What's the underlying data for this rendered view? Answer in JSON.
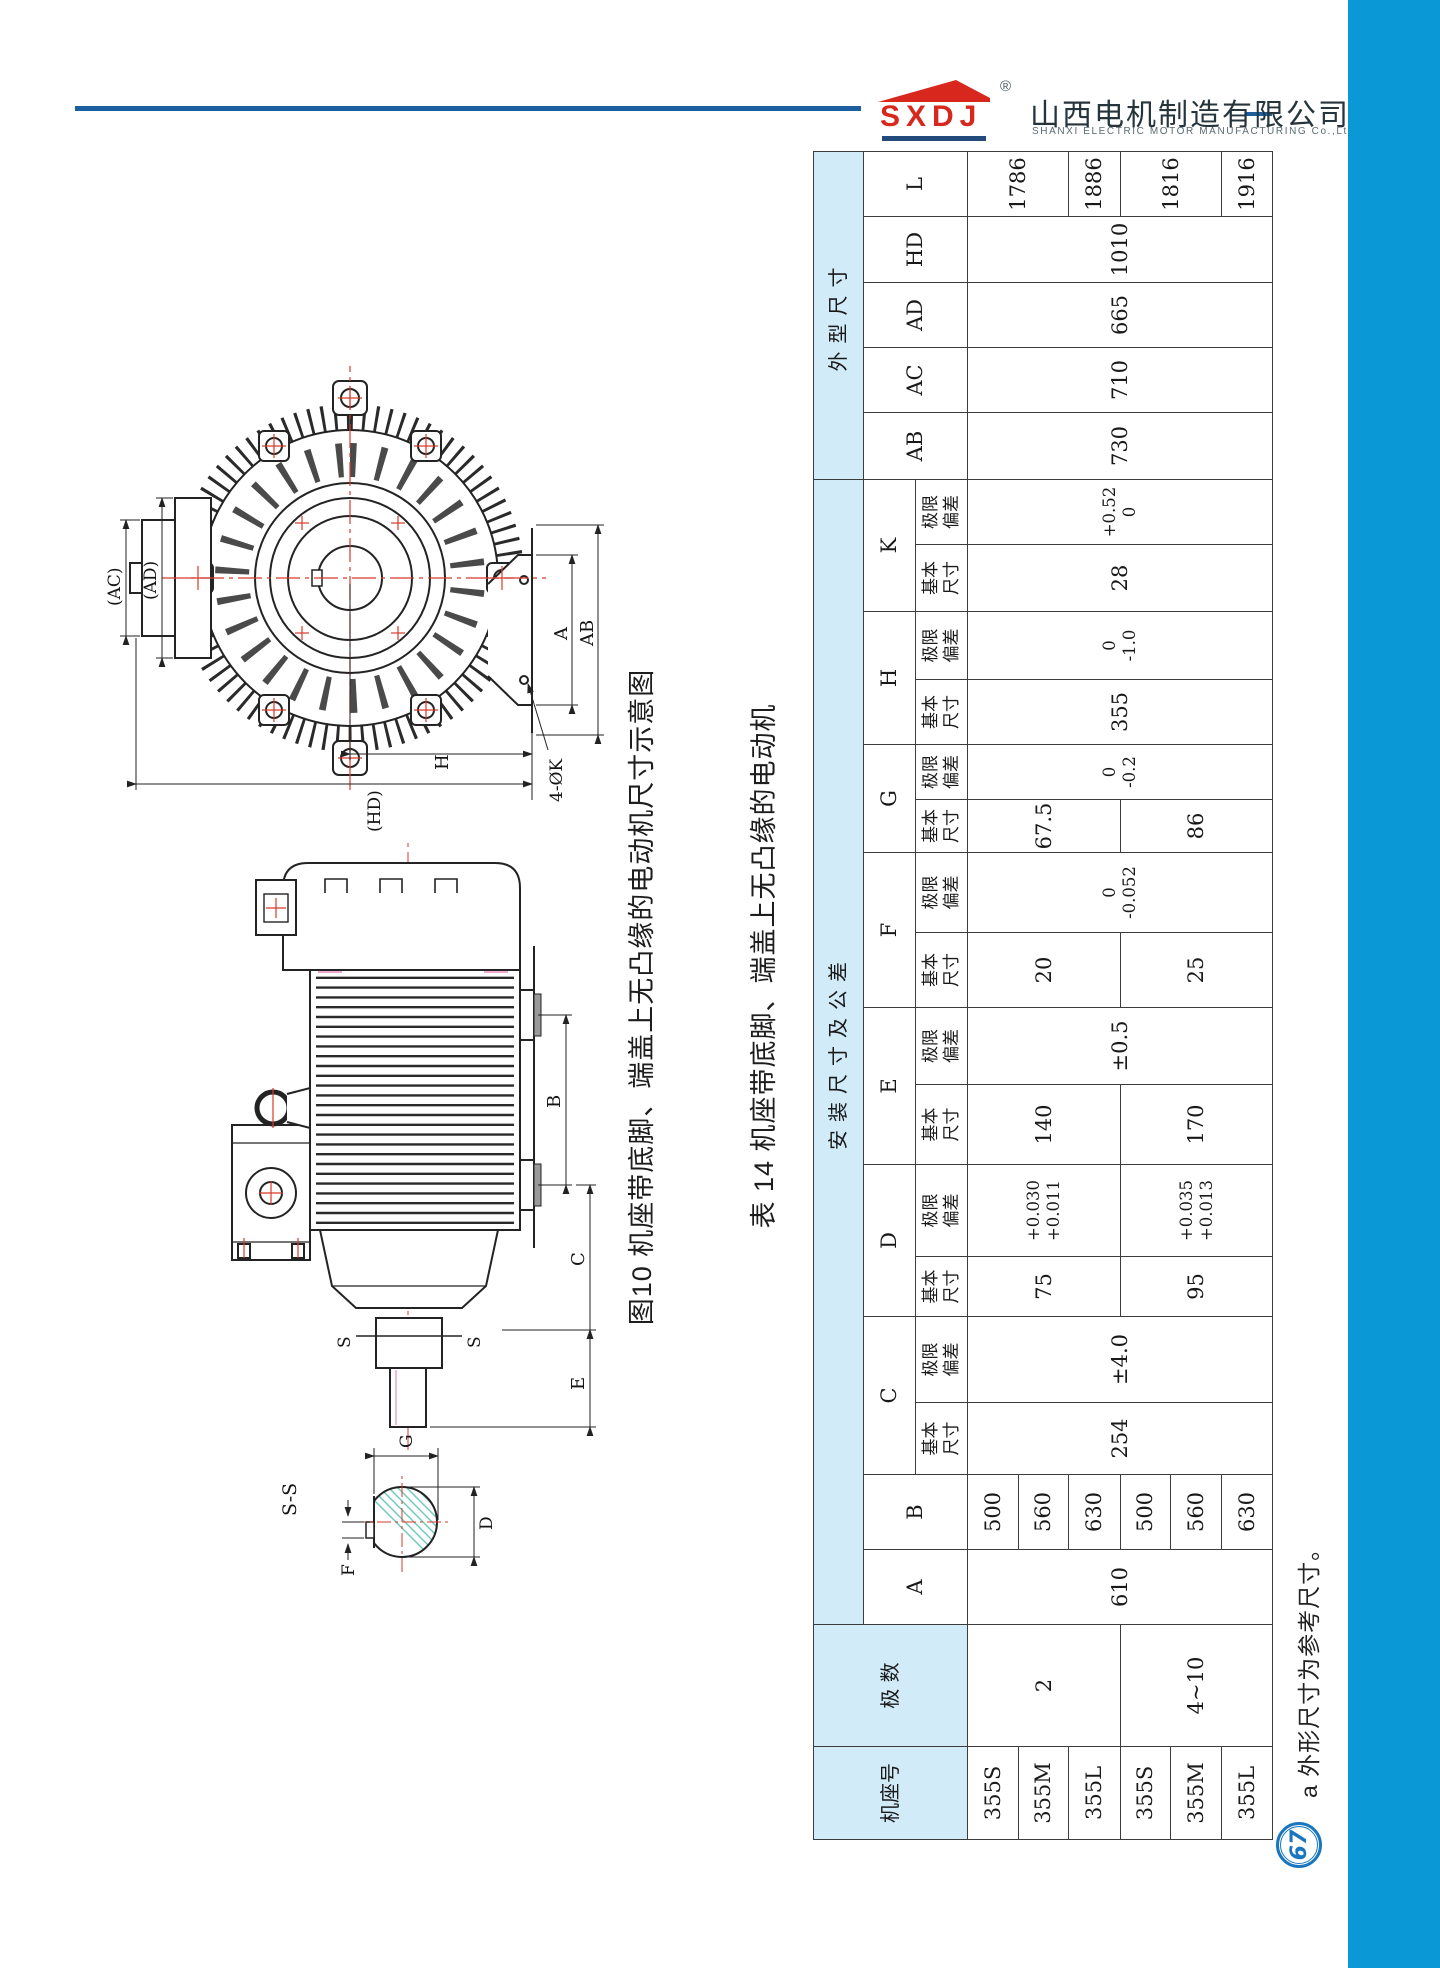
{
  "header": {
    "logo_text": "SXDJ",
    "registered_mark": "®",
    "company_cn": "山西电机制造有限公司",
    "company_en": "SHANXI ELECTRIC MOTOR MANUFACTURING Co.,Ltd."
  },
  "colors": {
    "sidebar_blue": "#0a99d6",
    "rule_blue": "#1d5f9e",
    "logo_red": "#d8281e",
    "table_header_blue": "#d2ebf8",
    "centerline_red": "#d83a2a",
    "hatch_teal": "#6cc9bd",
    "page_circle_blue": "#1b76c0"
  },
  "figure": {
    "caption": "图10 机座带底脚、端盖上无凸缘的电动机尺寸示意图",
    "labels": {
      "ac": "(AC)",
      "ad": "(AD)",
      "a": "A",
      "ab": "AB",
      "h": "H",
      "hd": "(HD)",
      "k4": "4-ØK",
      "b": "B",
      "c": "C",
      "e": "E",
      "f": "F",
      "g": "G",
      "d": "D",
      "ss": "S-S",
      "s": "S"
    }
  },
  "table": {
    "title": "表 14 机座带底脚、端盖上无凸缘的电动机",
    "headers": {
      "frame": "机座号",
      "poles": "极 数",
      "install_group": "安装尺寸及公差",
      "overall_group": "外型尺寸",
      "basic": "基本尺寸",
      "dev": "极限偏差",
      "cols": {
        "A": "A",
        "B": "B",
        "C": "C",
        "D": "D",
        "E": "E",
        "F": "F",
        "G": "G",
        "H": "H",
        "K": "K",
        "AB": "AB",
        "AC": "AC",
        "AD": "AD",
        "HD": "HD",
        "L": "L"
      }
    },
    "frames": [
      "355S",
      "355M",
      "355L",
      "355S",
      "355M",
      "355L"
    ],
    "poles_groups": [
      "2",
      "4~10"
    ],
    "A": "610",
    "B": [
      "500",
      "560",
      "630",
      "500",
      "560",
      "630"
    ],
    "C": {
      "basic": "254",
      "dev": "±4.0"
    },
    "D": {
      "basic": [
        "75",
        "95"
      ],
      "dev_top": [
        "+0.030",
        "+0.035"
      ],
      "dev_bot": [
        "+0.011",
        "+0.013"
      ]
    },
    "E": {
      "basic": [
        "140",
        "170"
      ],
      "dev": "±0.5"
    },
    "F": {
      "basic": [
        "20",
        "25"
      ],
      "dev_top": "0",
      "dev_bot": "-0.052"
    },
    "G": {
      "basic": [
        "67.5",
        "86"
      ],
      "dev_top": "0",
      "dev_bot": "-0.2"
    },
    "H": {
      "basic": "355",
      "dev_top": "0",
      "dev_bot": "-1.0"
    },
    "K": {
      "basic": "28",
      "dev_top": "+0.52",
      "dev_bot": "0"
    },
    "AB": "730",
    "AC": "710",
    "AD": "665",
    "HD": "1010",
    "L": [
      "1786",
      "1886",
      "1816",
      "1916"
    ]
  },
  "footnote": "a 外形尺寸为参考尺寸。",
  "page_number": "67"
}
